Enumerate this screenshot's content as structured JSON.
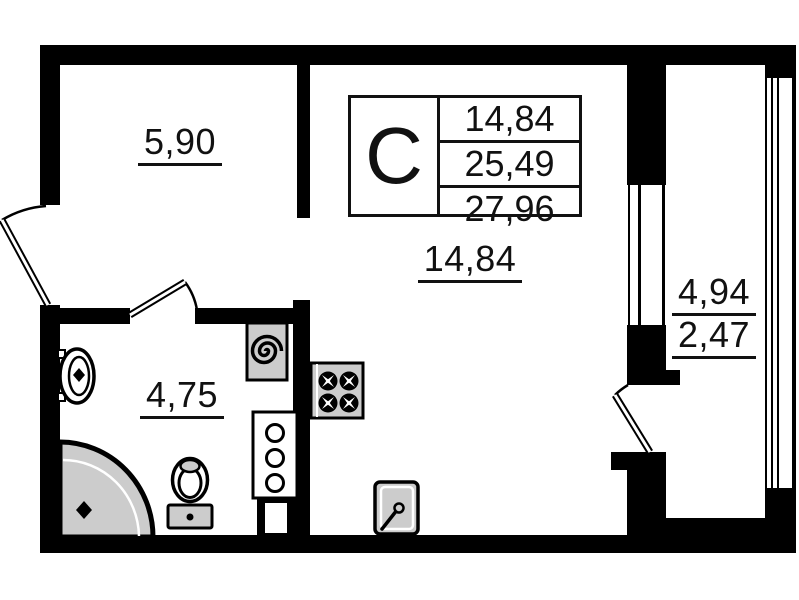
{
  "stamp": {
    "letter": "C",
    "areas": [
      "14,84",
      "25,49",
      "27,96"
    ]
  },
  "rooms": {
    "hallway": {
      "area": "5,90"
    },
    "living": {
      "area": "14,84"
    },
    "bathroom": {
      "area": "4,75"
    },
    "balcony": {
      "area_total": "4,94",
      "area_reduced": "2,47"
    }
  },
  "colors": {
    "wall": "#000000",
    "fixture_fill": "#cccccc",
    "background": "#ffffff",
    "text": "#111111"
  }
}
